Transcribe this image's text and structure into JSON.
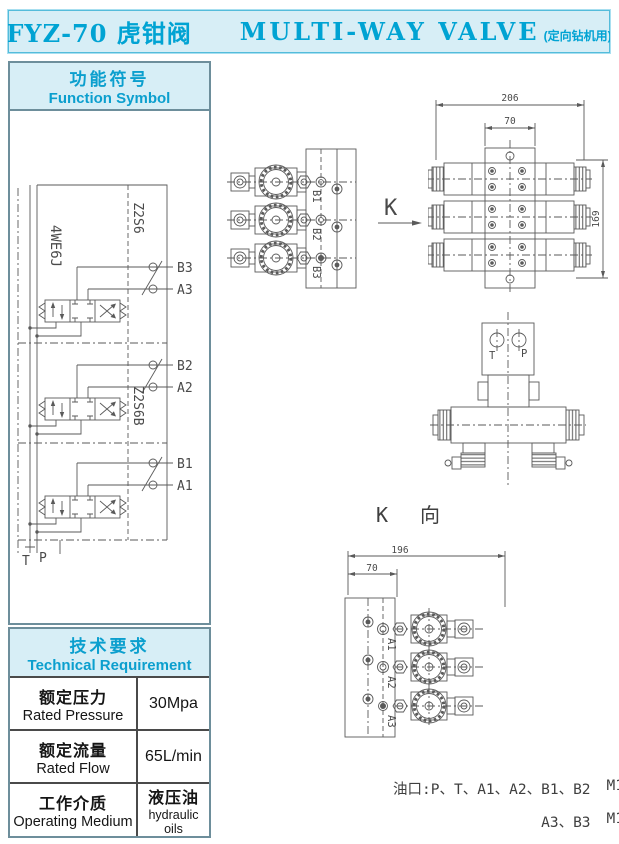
{
  "page": {
    "accent": "#00a3d3",
    "accent_bg": "#d7eef6",
    "line_color": "#5a5a5a"
  },
  "title": {
    "model": "FYZ-70 虎钳阀",
    "name": "MULTI-WAY  VALVE",
    "note": "(定向钻机用)"
  },
  "function_symbol": {
    "heading_zh": "功能符号",
    "heading_en": "Function Symbol"
  },
  "circuit": {
    "valve_model": "4WE6J",
    "check_module_top": "Z2S6",
    "check_module_mid": "Z2S6B",
    "sections": [
      {
        "b": "B3",
        "a": "A3"
      },
      {
        "b": "B2",
        "a": "A2"
      },
      {
        "b": "B1",
        "a": "A1"
      }
    ],
    "tank_label": "T",
    "pump_label": "P"
  },
  "technical_requirement": {
    "heading_zh": "技术要求",
    "heading_en": "Technical Requirement",
    "rows": [
      {
        "label_zh": "额定压力",
        "label_en": "Rated Pressure",
        "value": "30Mpa",
        "value_sub": ""
      },
      {
        "label_zh": "额定流量",
        "label_en": "Rated Flow",
        "value": "65L/min",
        "value_sub": ""
      },
      {
        "label_zh": "工作介质",
        "label_en": "Operating Medium",
        "value": "液压油",
        "value_sub": "hydraulic oils"
      }
    ]
  },
  "drawings": {
    "side_view": {
      "port_labels": [
        "B1",
        "B2",
        "B3"
      ]
    },
    "view_arrow": {
      "label": "K"
    },
    "front_view": {
      "dim_width": "206",
      "dim_inner": "70",
      "dim_height": "169"
    },
    "top_view": {
      "port_t": "T",
      "port_p": "P"
    },
    "k_view": {
      "title": "K 向",
      "dim_width": "196",
      "dim_inner": "70",
      "port_labels": [
        "A1",
        "A2",
        "A3"
      ]
    }
  },
  "ports_note": {
    "line1_ports": "油口:P、T、A1、A2、B1、B2",
    "line1_thread": "M16*1.5",
    "line2_ports": "A3、B3",
    "line2_thread": "M12*1.5"
  }
}
